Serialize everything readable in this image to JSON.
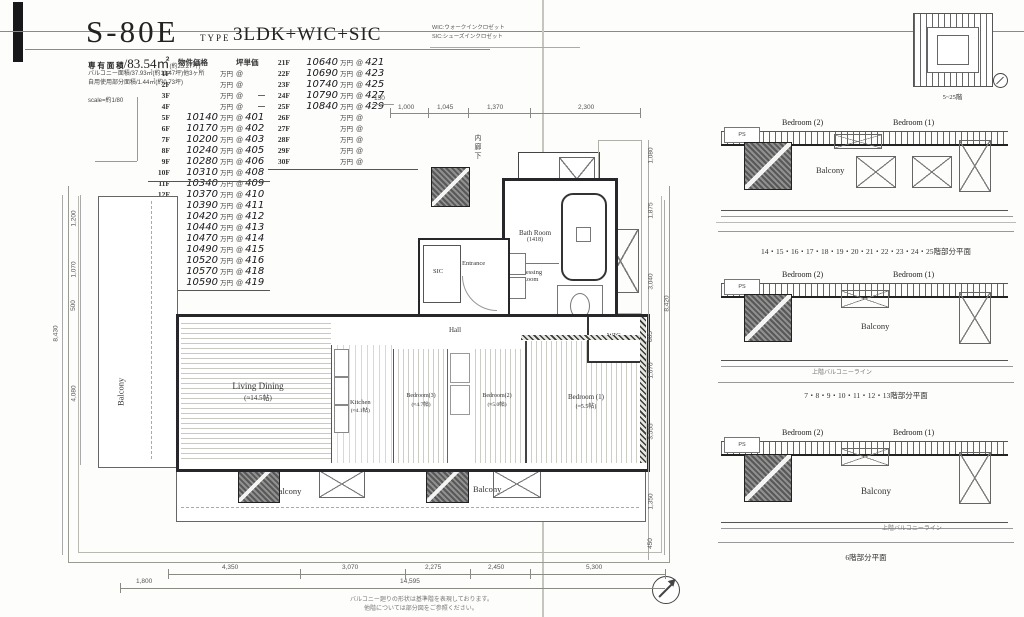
{
  "title": {
    "code": "S-80E",
    "type_label": "TYPE",
    "type_value": "3LDK+WIC+SIC"
  },
  "legend": {
    "wic": "WIC:ウォークインクロゼット",
    "sic": "SIC:シューズインクロゼット"
  },
  "info": {
    "area_label": "専 有 面 積",
    "area_value": "/83.54㎡",
    "area_tsubo": "(約25.27坪)",
    "balcony_line": "バルコニー面積/37.93㎡(約11.47坪)他3ヶ所",
    "other_line": "自用使用部分面積/1.44㎡(約0.73坪)",
    "scale_line": "scale=約1/80"
  },
  "price_table": {
    "headers": {
      "price": "物件価格",
      "tsubo": "坪単価"
    },
    "suffix": {
      "price": "万円",
      "at": "@"
    },
    "left": [
      {
        "f": "1F",
        "p": "",
        "u": ""
      },
      {
        "f": "2F",
        "p": "",
        "u": ""
      },
      {
        "f": "3F",
        "p": "",
        "u": ""
      },
      {
        "f": "4F",
        "p": "",
        "u": ""
      },
      {
        "f": "5F",
        "p": "10140",
        "u": "401"
      },
      {
        "f": "6F",
        "p": "10170",
        "u": "402"
      },
      {
        "f": "7F",
        "p": "10200",
        "u": "403"
      },
      {
        "f": "8F",
        "p": "10240",
        "u": "405"
      },
      {
        "f": "9F",
        "p": "10280",
        "u": "406"
      },
      {
        "f": "10F",
        "p": "10310",
        "u": "408"
      },
      {
        "f": "11F",
        "p": "10340",
        "u": "409"
      },
      {
        "f": "12F",
        "p": "10370",
        "u": "410"
      },
      {
        "f": "13F",
        "p": "10390",
        "u": "411"
      },
      {
        "f": "14F",
        "p": "10420",
        "u": "412"
      },
      {
        "f": "15F",
        "p": "10440",
        "u": "413"
      },
      {
        "f": "16F",
        "p": "10470",
        "u": "414"
      },
      {
        "f": "17F",
        "p": "10490",
        "u": "415"
      },
      {
        "f": "18F",
        "p": "10520",
        "u": "416"
      },
      {
        "f": "19F",
        "p": "10570",
        "u": "418"
      },
      {
        "f": "20F",
        "p": "10590",
        "u": "419"
      }
    ],
    "right": [
      {
        "f": "21F",
        "p": "10640",
        "u": "421"
      },
      {
        "f": "22F",
        "p": "10690",
        "u": "423"
      },
      {
        "f": "23F",
        "p": "10740",
        "u": "425"
      },
      {
        "f": "24F",
        "p": "10790",
        "u": "427"
      },
      {
        "f": "25F",
        "p": "10840",
        "u": "429"
      },
      {
        "f": "26F",
        "p": "",
        "u": ""
      },
      {
        "f": "27F",
        "p": "",
        "u": ""
      },
      {
        "f": "28F",
        "p": "",
        "u": ""
      },
      {
        "f": "29F",
        "p": "",
        "u": ""
      },
      {
        "f": "30F",
        "p": "",
        "u": ""
      }
    ]
  },
  "rooms": {
    "living_name": "Living Dining",
    "living_size": "(≈14.5帖)",
    "kitchen_name": "Kitchen",
    "kitchen_size": "(≈4.1帖)",
    "bedroom3_name": "Bedroom(3)",
    "bedroom3_size": "(≈4.7帖)",
    "bedroom2_name": "Bedroom(2)",
    "bedroom2_size": "(≈5.0帖)",
    "bedroom1_name": "Bedroom (1)",
    "bedroom1_size": "(≈5.5帖)",
    "bath_name": "Bath Room",
    "bath_size": "(1418)",
    "dressing_line1": "Dressing",
    "dressing_line2": "Room",
    "hall": "Hall",
    "entrance": "Entrance",
    "sic": "SIC",
    "wic": "WIC",
    "corridor": "内廊下",
    "balcony_left": "Balcony",
    "balcony_bottom1": "Balcony",
    "balcony_bottom2": "Balcony"
  },
  "dims": {
    "top": [
      "150",
      "1,000",
      "1,045",
      "1,370",
      "2,300"
    ],
    "left": [
      "1,200",
      "1,070",
      "500",
      "4,080",
      "8,430"
    ],
    "right": [
      "1,080",
      "1,875",
      "3,040",
      "805",
      "1,070",
      "3,555",
      "8,420",
      "1,350",
      "450"
    ],
    "bottom": [
      "4,350",
      "3,070",
      "2,275",
      "2,450",
      "5,300"
    ],
    "bottom2": [
      "1,800",
      "14,595"
    ]
  },
  "footnote": {
    "line1": "バルコニー廻りの形状は基準階を表現しております。",
    "line2": "他階については部分図をご参照ください。"
  },
  "keyplan": {
    "caption": "5~25階"
  },
  "panels": [
    {
      "ps": "PS",
      "bedroom2": "Bedroom (2)",
      "bedroom1": "Bedroom (1)",
      "balcony": "Balcony",
      "note": "",
      "caption": "14・15・16・17・18・19・20・21・22・23・24・25階部分平面"
    },
    {
      "ps": "PS",
      "bedroom2": "Bedroom (2)",
      "bedroom1": "Bedroom (1)",
      "balcony": "Balcony",
      "note": "上階バルコニーライン",
      "caption": "7・8・9・10・11・12・13階部分平面"
    },
    {
      "ps": "PS",
      "bedroom2": "Bedroom (2)",
      "bedroom1": "Bedroom (1)",
      "balcony": "Balcony",
      "note": "上階バルコニーライン",
      "caption": "6階部分平面"
    }
  ]
}
